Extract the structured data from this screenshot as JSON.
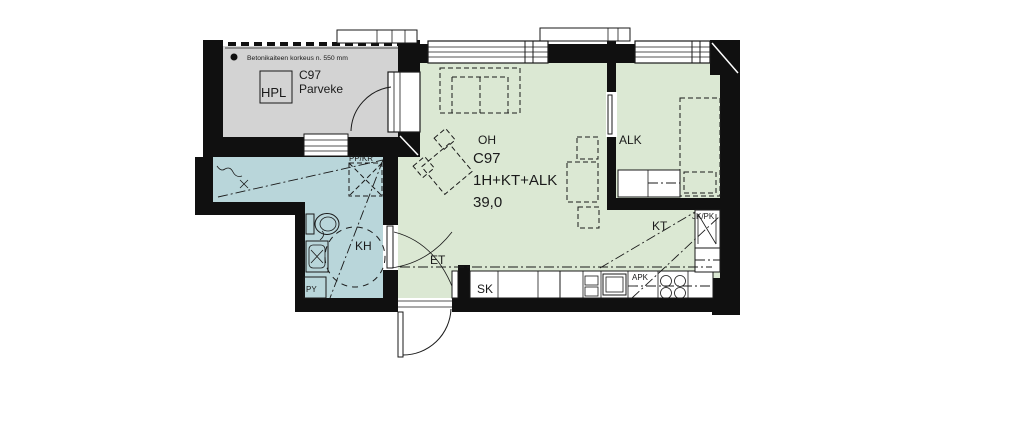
{
  "colors": {
    "wall": "#101010",
    "balcony_floor": "#d3d3d3",
    "bathroom_floor": "#b9d6da",
    "living_floor": "#dbe8d3",
    "background": "#ffffff",
    "line": "#1a1a1a"
  },
  "apartment": {
    "code": "C97",
    "layout": "1H+KT+ALK",
    "area": "39,0"
  },
  "balcony": {
    "code": "C97",
    "name": "Parveke",
    "railing_note": "Betonikaiteen korkeus n. 550 mm",
    "hpl": "HPL"
  },
  "rooms": {
    "living": "OH",
    "alcove": "ALK",
    "kitchen": "KT",
    "bathroom": "KH",
    "entry": "ET",
    "cleaning_closet": "SK"
  },
  "labels": {
    "washer_dryer_reservation": "PP/KR",
    "laundry_reservation": "PY",
    "dishwasher": "APK",
    "fridge_freezer": "JK/PK"
  }
}
